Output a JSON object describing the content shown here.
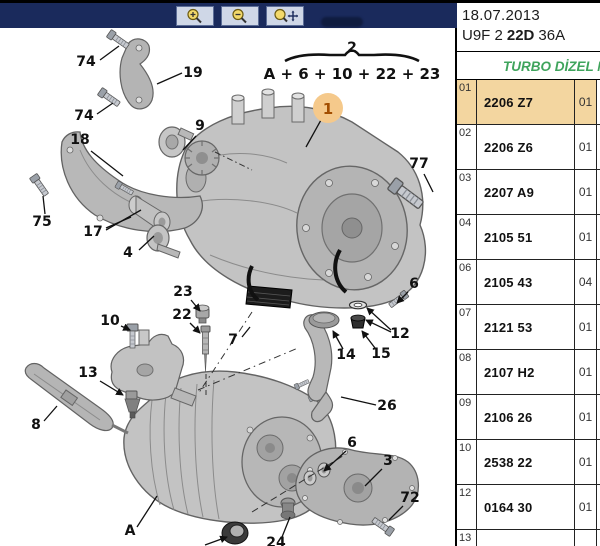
{
  "toolbar": {
    "buttons": [
      {
        "icon": "zoom-in-icon"
      },
      {
        "icon": "zoom-out-icon"
      },
      {
        "icon": "zoom-pan-icon"
      }
    ]
  },
  "panel": {
    "date": "18.07.2013",
    "code": {
      "part1": "U9F 2",
      "part2": "22D",
      "part3": "36A"
    },
    "category": "TURBO DİZEL M",
    "rows": [
      {
        "num": "01",
        "part": "2206 Z7",
        "qty": "01",
        "highlighted": true
      },
      {
        "num": "02",
        "part": "2206 Z6",
        "qty": "01",
        "highlighted": false
      },
      {
        "num": "03",
        "part": "2207 A9",
        "qty": "01",
        "highlighted": false
      },
      {
        "num": "04",
        "part": "2105 51",
        "qty": "01",
        "highlighted": false
      },
      {
        "num": "06",
        "part": "2105 43",
        "qty": "04",
        "highlighted": false
      },
      {
        "num": "07",
        "part": "2121 53",
        "qty": "01",
        "highlighted": false
      },
      {
        "num": "08",
        "part": "2107 H2",
        "qty": "01",
        "highlighted": false
      },
      {
        "num": "09",
        "part": "2106 26",
        "qty": "01",
        "highlighted": false
      },
      {
        "num": "10",
        "part": "2538 22",
        "qty": "01",
        "highlighted": false
      },
      {
        "num": "12",
        "part": "0164 30",
        "qty": "01",
        "highlighted": false
      },
      {
        "num": "13",
        "part": "",
        "qty": "",
        "highlighted": false
      }
    ]
  },
  "diagram": {
    "group_callout": {
      "number": "2",
      "formula": "A + 6 + 10 + 22 + 23"
    },
    "highlighted_callout": {
      "label": "1"
    },
    "callouts": [
      {
        "label": "74"
      },
      {
        "label": "19"
      },
      {
        "label": "74"
      },
      {
        "label": "18"
      },
      {
        "label": "75"
      },
      {
        "label": "9"
      },
      {
        "label": "17"
      },
      {
        "label": "4"
      },
      {
        "label": "23"
      },
      {
        "label": "22"
      },
      {
        "label": "10"
      },
      {
        "label": "13"
      },
      {
        "label": "8"
      },
      {
        "label": "7"
      },
      {
        "label": "14"
      },
      {
        "label": "15"
      },
      {
        "label": "12"
      },
      {
        "label": "6"
      },
      {
        "label": "26"
      },
      {
        "label": "6"
      },
      {
        "label": "3"
      },
      {
        "label": "72"
      },
      {
        "label": "24"
      },
      {
        "label": "A"
      },
      {
        "label": "77"
      }
    ],
    "colors": {
      "toolbar_navy": "#1a2a5c",
      "highlight_circle": "#f5c98b",
      "highlight_row": "#f3d6a0",
      "category_green": "#3fa45c"
    }
  }
}
